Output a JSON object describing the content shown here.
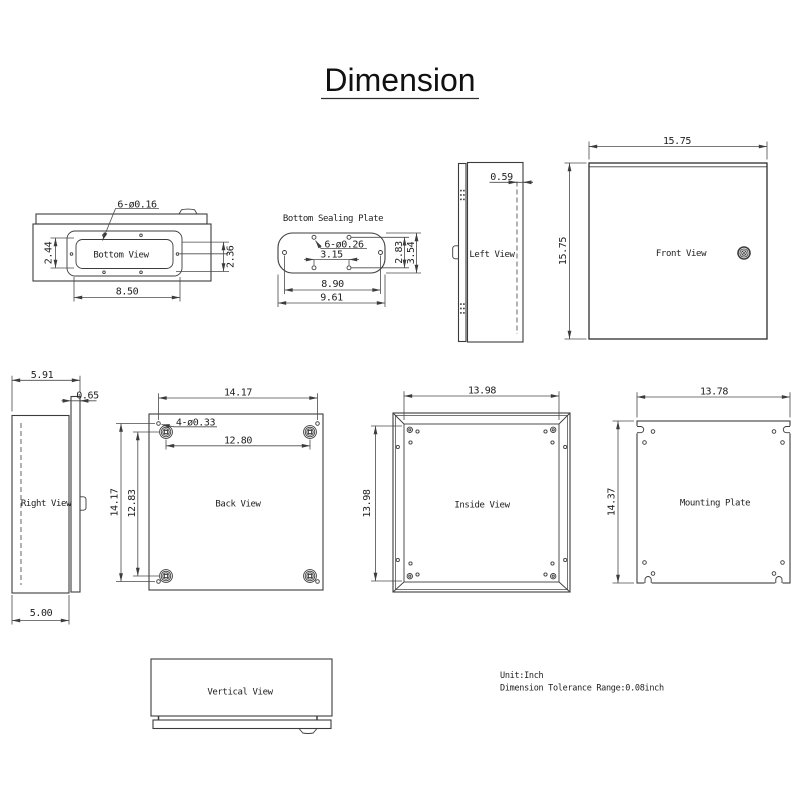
{
  "title": "Dimension",
  "notes": {
    "unit": "Unit:Inch",
    "tolerance": "Dimension Tolerance Range:0.08inch"
  },
  "views": {
    "bottom_view": {
      "label": "Bottom View",
      "holes_note": "6-ø0.16",
      "gasket_height": "2.44",
      "side_height": "2.36",
      "gasket_width": "8.50"
    },
    "sealing_plate": {
      "label": "Bottom Sealing Plate",
      "holes_note": "6-ø0.26",
      "slot_spacing": "3.15",
      "hole_span_height": "2.83",
      "height": "3.54",
      "hole_span_width": "8.90",
      "width": "9.61"
    },
    "left_view": {
      "label": "Left View",
      "door_offset": "0.59"
    },
    "front_view": {
      "label": "Front View",
      "width": "15.75",
      "height": "15.75"
    },
    "right_view": {
      "label": "Right View",
      "overall_depth": "5.91",
      "door_thickness": "0.65",
      "body_depth": "5.00"
    },
    "back_view": {
      "label": "Back View",
      "width": "14.17",
      "height": "14.17",
      "holes_note": "4-ø0.33",
      "boss_span_width": "12.80",
      "boss_span_height": "12.83"
    },
    "inside_view": {
      "label": "Inside View",
      "width": "13.98",
      "height": "13.98"
    },
    "mounting_plate": {
      "label": "Mounting Plate",
      "width": "13.78",
      "height": "14.37"
    },
    "vertical_view": {
      "label": "Vertical View"
    }
  }
}
